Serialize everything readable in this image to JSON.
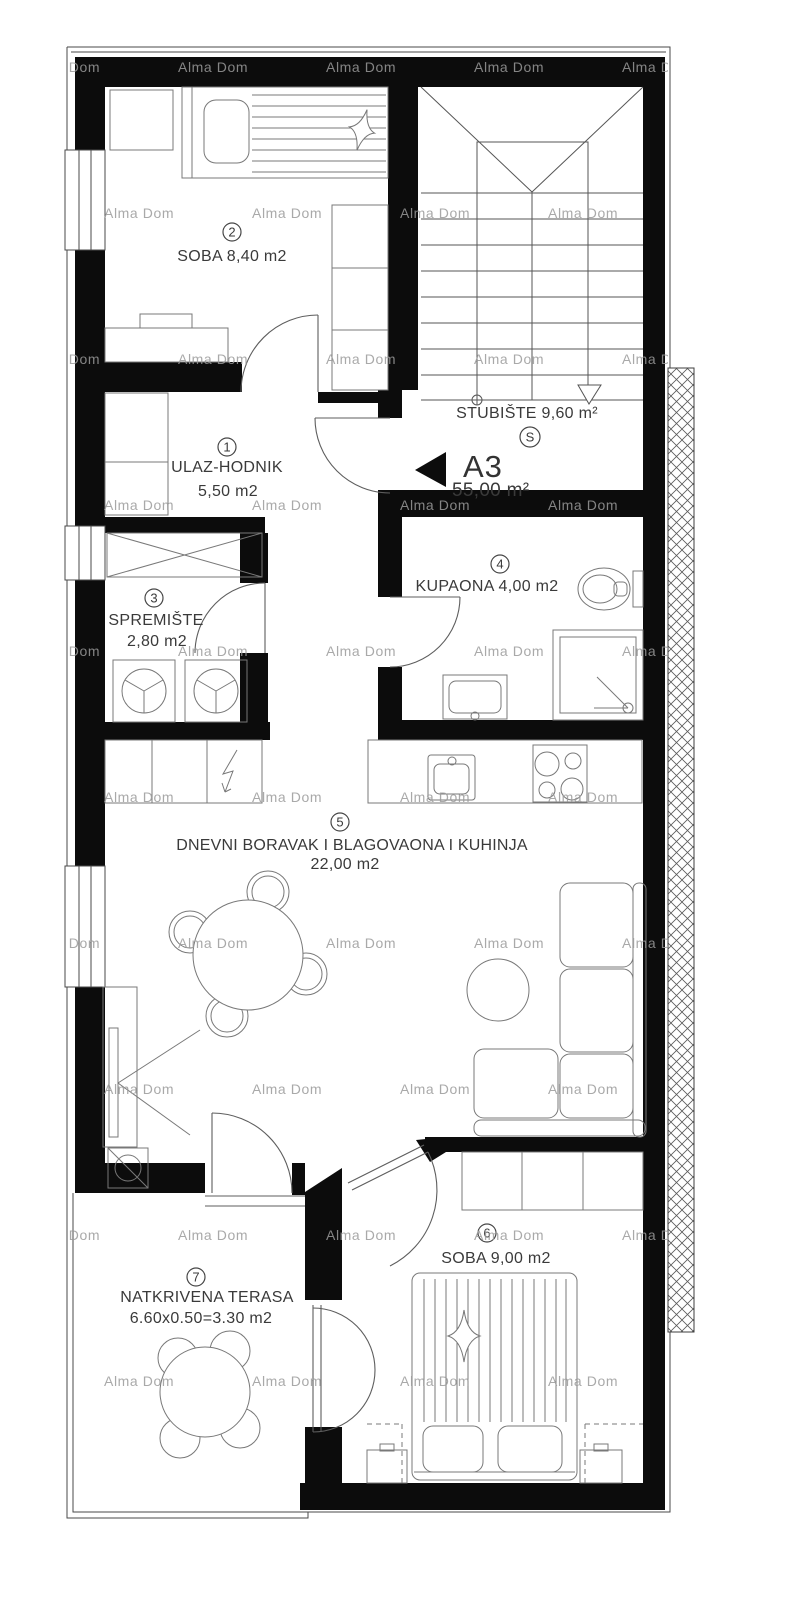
{
  "watermark": {
    "text": "Alma Dom"
  },
  "unit_marker": {
    "code": "A3",
    "area": "55,00 m²"
  },
  "stairwell": {
    "label": "STUBIŠTE  9,60 m²",
    "symbol": "S"
  },
  "rooms": {
    "r1": {
      "num": "1",
      "line1": "ULAZ-HODNIK",
      "line2": "5,50 m2"
    },
    "r2": {
      "num": "2",
      "line1": "SOBA 8,40 m2"
    },
    "r3": {
      "num": "3",
      "line1": "SPREMIŠTE",
      "line2": "2,80 m2"
    },
    "r4": {
      "num": "4",
      "line1": "KUPAONA 4,00 m2"
    },
    "r5": {
      "num": "5",
      "line1": "DNEVNI BORAVAK I BLAGOVAONA I KUHINJA",
      "line2": "22,00 m2"
    },
    "r6": {
      "num": "6",
      "line1": "SOBA 9,00 m2"
    },
    "r7": {
      "num": "7",
      "line1": "NATKRIVENA TERASA",
      "line2": "6.60x0.50=3.30 m2"
    }
  },
  "icons": [
    "bed-icon",
    "pillow-icon",
    "star-icon",
    "wardrobe-icon",
    "desk-icon",
    "closet-icon",
    "stairs-icon",
    "toilet-icon",
    "shower-icon",
    "sink-icon",
    "washing-machine-icon",
    "kitchen-sink-icon",
    "stove-icon",
    "dishwasher-bolt-icon",
    "dining-table-icon",
    "chair-icon",
    "sofa-icon",
    "coffee-table-icon",
    "tv-cabinet-icon",
    "plant-icon",
    "terrace-table-icon",
    "door-arc-icon",
    "window-icon",
    "direction-arrow-icon"
  ],
  "colors": {
    "wall": "#0c0c0c",
    "furniture_line": "#787878",
    "watermark": "#9b9b9b",
    "label": "#3a3a3a"
  }
}
